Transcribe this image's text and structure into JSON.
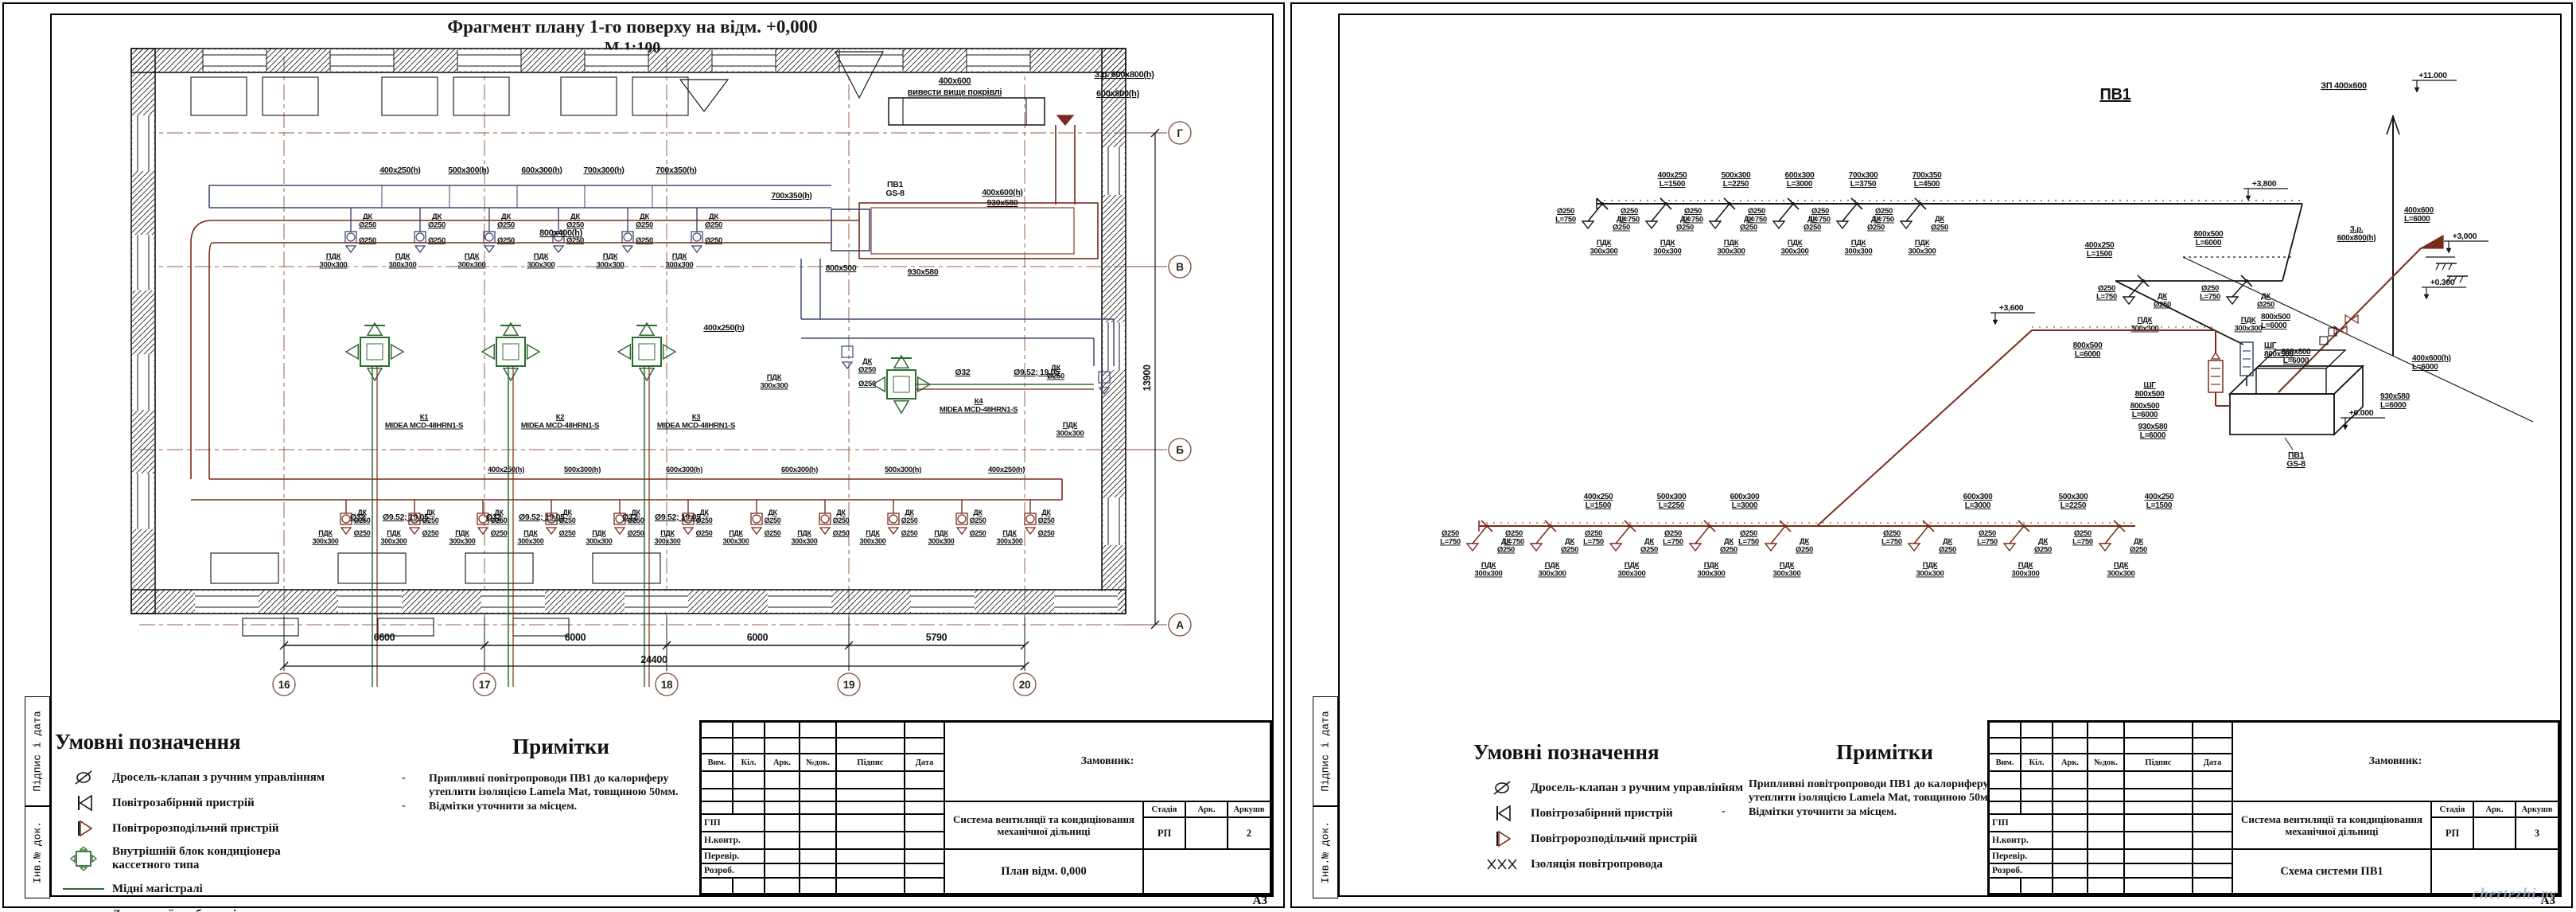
{
  "watermark": "chertezhi.ру",
  "colors": {
    "supply_duct": "#7a2b1c",
    "exhaust_duct": "#3d4a6e",
    "refrigerant": "#2f6b30",
    "axis": "#96604e",
    "ink": "#151515"
  },
  "shared": {
    "margin_signature": "Підпис і дата",
    "margin_inventory": "Інв.№ док.",
    "format": "А3",
    "legend_title": "Умовні позначення",
    "notes_title": "Примітки",
    "notes": [
      "Припливні  повітропроводи ПВ1 до калориферу утеплити ізоляцією Lamela Mat, товщиною 50мм.",
      "Відмітки уточнити за місцем."
    ],
    "titleblock": {
      "headers": [
        "Вим.",
        "Кіл.",
        "Арк.",
        "№док.",
        "Підпис",
        "Дата"
      ],
      "customer": "Замовник:",
      "project": "Система  вентиляції та кондиціювання механічної  дільниці",
      "stage_h": "Стадія",
      "sheet_h": "Арк.",
      "sheets_h": "Аркушв",
      "stage": "РП",
      "roles": [
        "ГІП",
        "Н.контр.",
        "Перевір.",
        "Розроб."
      ]
    }
  },
  "left": {
    "title": "Фрагмент плану 1-го поверху на відм. +0,000",
    "scale": "М 1:100",
    "sheet_no": "2",
    "drawing_name": "План відм. 0,000",
    "legend": [
      {
        "sym": "damper",
        "label": "Дросель-клапан з ручним управлінням"
      },
      {
        "sym": "intake",
        "label": "Повітрозабірний пристрій"
      },
      {
        "sym": "distributor",
        "label": "Повітророзподільчий пристрій"
      },
      {
        "sym": "cassette",
        "label": "Внутрішній блок кондиціонера кассетного типа"
      },
      {
        "sym": "copper",
        "label": "Мідні магістралі"
      },
      {
        "sym": "drain",
        "label": "Дренажний трубопровід"
      }
    ],
    "plan": {
      "axes_bottom": [
        "16",
        "17",
        "18",
        "19",
        "20"
      ],
      "axes_right": [
        "Г",
        "В",
        "Б",
        "А"
      ],
      "dims_bottom": [
        "6600",
        "6000",
        "6000",
        "5790"
      ],
      "dim_total": "24400",
      "dim_right": "13900",
      "blue_run_segments": [
        "400x250(h)",
        "500x300(h)",
        "600x300(h)",
        "700x300(h)",
        "700x350(h)"
      ],
      "red_run_segments": [
        "400x250(h)",
        "500x300(h)",
        "600x300(h)",
        "600x300(h)",
        "500x300(h)",
        "400x250(h)"
      ],
      "red_trunk_label": "800x400(h)",
      "branch_label": "400x250(h)",
      "group": {
        "dk": "ДК",
        "d1": "Ø250",
        "d2": "Ø250",
        "pdk": "ПДК",
        "size": "300x300"
      },
      "units": [
        {
          "tag": "К1",
          "model": "MIDEA MCD-48HRN1-S"
        },
        {
          "tag": "К2",
          "model": "MIDEA MCD-48HRN1-S"
        },
        {
          "tag": "К3",
          "model": "MIDEA MCD-48HRN1-S"
        },
        {
          "tag": "К4",
          "model": "MIDEA MCD-48HRN1-S"
        }
      ],
      "pipes": {
        "d32": "Ø32",
        "copper": "Ø9.52; 19.05"
      },
      "roof_duct": {
        "size": "400x600",
        "note": "вивести вище покрівлі"
      },
      "zr_label": "З.р. 600x800(h)",
      "duct_600x800": "600x800(h)",
      "ahu": {
        "tag": "ПВ1",
        "model": "GS-8"
      },
      "ahu_labels": {
        "a1": "400x600(h)",
        "a2": "930x580",
        "a3": "800x500",
        "a4": "930x580",
        "a5": "700x350(h)"
      }
    }
  },
  "right": {
    "title": "ПВ1",
    "sheet_no": "3",
    "drawing_name": "Схема системи ПВ1",
    "legend": [
      {
        "sym": "damper",
        "label": "Дросель-клапан з ручним управлінням"
      },
      {
        "sym": "intake",
        "label": "Повітрозабірний пристрій"
      },
      {
        "sym": "distributor",
        "label": "Повітророзподільчий пристрій"
      },
      {
        "sym": "insulation",
        "label": "Ізоляція повітропровода"
      }
    ],
    "scheme": {
      "drop": {
        "d": "Ø250",
        "l": "L=750",
        "dk": "ДК",
        "pdk": "ПДК",
        "size": "300x300"
      },
      "top_segments": [
        [
          "400x250",
          "L=1500"
        ],
        [
          "500x300",
          "L=2250"
        ],
        [
          "600x300",
          "L=3000"
        ],
        [
          "700x300",
          "L=3750"
        ],
        [
          "700x350",
          "L=4500"
        ]
      ],
      "bottom_segments_left": [
        [
          "400x250",
          "L=1500"
        ],
        [
          "500x300",
          "L=2250"
        ],
        [
          "600x300",
          "L=3000"
        ]
      ],
      "bottom_segments_right": [
        [
          "600x300",
          "L=3000"
        ],
        [
          "500x300",
          "L=2250"
        ],
        [
          "400x250",
          "L=1500"
        ]
      ],
      "stub_label": [
        "400x250",
        "L=1500"
      ],
      "stub_duct": [
        "800x500",
        "L=6000"
      ],
      "riser": {
        "label": "ЗП 400x600",
        "top_elev": "+11.000",
        "duct": [
          "400x600",
          "L=6000"
        ]
      },
      "elev_top_branch": "+3,800",
      "elev_junction": "+3,600",
      "elev_zero": "+0.000",
      "elev_ground": "+0.300",
      "elev_intake": "+3,000",
      "junction_duct": [
        "800x500",
        "L=6000"
      ],
      "intake": {
        "zr": [
          "З.р.",
          "600x800(h)"
        ],
        "duct": [
          "600x800",
          "L=6000"
        ],
        "floor": [
          "400x600(h)",
          "L=6000"
        ]
      },
      "ahu": {
        "tag": "ПВ1",
        "model": "GS-8",
        "sg": "ШГ",
        "sg_size": "800x500",
        "duct": [
          "800x500",
          "L=6000"
        ],
        "conn": [
          "930x580",
          "L=6000"
        ]
      }
    }
  }
}
